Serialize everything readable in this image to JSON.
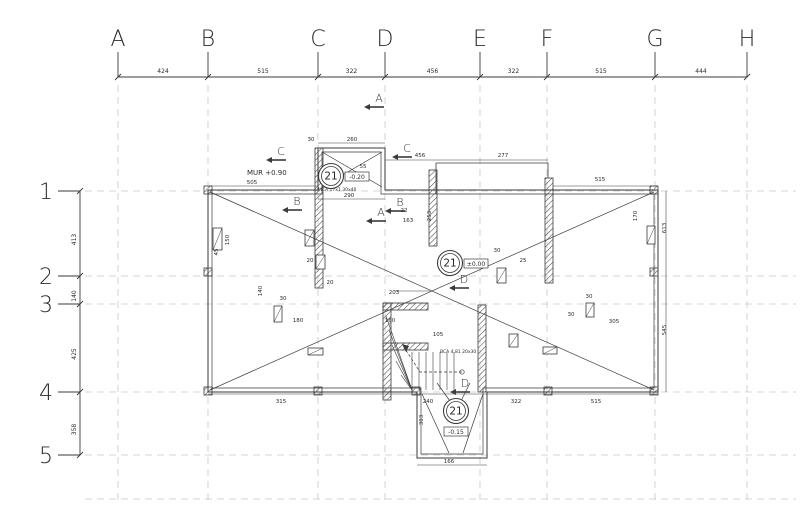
{
  "drawing": {
    "colors": {
      "line": "#3a3a3a",
      "grid": "#c8c8c8",
      "hatch": "#4a4a4a",
      "text": "#2a2a2a"
    },
    "axes": {
      "cols": [
        {
          "label": "A",
          "x": 118
        },
        {
          "label": "B",
          "x": 208
        },
        {
          "label": "C",
          "x": 318
        },
        {
          "label": "D",
          "x": 385
        },
        {
          "label": "E",
          "x": 480
        },
        {
          "label": "F",
          "x": 547
        },
        {
          "label": "G",
          "x": 655
        },
        {
          "label": "H",
          "x": 747
        }
      ],
      "col_dims": [
        "424",
        "515",
        "322",
        "456",
        "322",
        "515",
        "444"
      ],
      "rows": [
        {
          "label": "1",
          "y": 191
        },
        {
          "label": "2",
          "y": 276
        },
        {
          "label": "3",
          "y": 304
        },
        {
          "label": "4",
          "y": 392
        },
        {
          "label": "5",
          "y": 455
        }
      ],
      "row_dims": [
        "413",
        "140",
        "425",
        "358"
      ],
      "top_dim_y": 77,
      "left_dim_x": 80,
      "extra_row_y": 499
    },
    "levels": [
      {
        "num": "21",
        "value": "-0.20",
        "x": 331,
        "y": 176,
        "bx": 14,
        "by": -4
      },
      {
        "num": "21",
        "value": "±0.00",
        "x": 450,
        "y": 263,
        "bx": 14,
        "by": -4
      },
      {
        "num": "21",
        "value": "-0.15",
        "x": 456,
        "y": 411,
        "bx": -12,
        "by": 16
      }
    ],
    "sections": [
      {
        "l": "A",
        "x": 379,
        "y": 102
      },
      {
        "l": "A",
        "x": 381,
        "y": 216
      },
      {
        "l": "B",
        "x": 297,
        "y": 205
      },
      {
        "l": "B",
        "x": 400,
        "y": 206
      },
      {
        "l": "C",
        "x": 281,
        "y": 155
      },
      {
        "l": "C",
        "x": 407,
        "y": 152
      },
      {
        "l": "D",
        "x": 464,
        "y": 283
      },
      {
        "l": "D",
        "x": 465,
        "y": 387
      }
    ],
    "notes": [
      {
        "t": "MUR +0.90",
        "x": 247,
        "y": 175,
        "s": 7
      },
      {
        "t": "MCA 17x1 30x40",
        "x": 318,
        "y": 191,
        "s": 4.5
      },
      {
        "t": "BCA 4.81 20x30",
        "x": 440,
        "y": 353,
        "s": 4.5
      }
    ],
    "dims": [
      {
        "t": "505",
        "x": 252,
        "y": 184
      },
      {
        "t": "260",
        "x": 352,
        "y": 141
      },
      {
        "t": "30",
        "x": 311,
        "y": 141
      },
      {
        "t": "456",
        "x": 420,
        "y": 157
      },
      {
        "t": "277",
        "x": 503,
        "y": 157
      },
      {
        "t": "515",
        "x": 600,
        "y": 181
      },
      {
        "t": "290",
        "x": 349,
        "y": 197
      },
      {
        "t": "163",
        "x": 408,
        "y": 222
      },
      {
        "t": "253",
        "x": 431,
        "y": 216,
        "r": 1
      },
      {
        "t": "613",
        "x": 666,
        "y": 228,
        "r": 1
      },
      {
        "t": "545",
        "x": 666,
        "y": 330,
        "r": 1
      },
      {
        "t": "150",
        "x": 229,
        "y": 240,
        "r": 1
      },
      {
        "t": "140",
        "x": 262,
        "y": 291,
        "r": 1
      },
      {
        "t": "170",
        "x": 637,
        "y": 216,
        "r": 1
      },
      {
        "t": "180",
        "x": 298,
        "y": 322
      },
      {
        "t": "203",
        "x": 394,
        "y": 294
      },
      {
        "t": "160",
        "x": 390,
        "y": 322
      },
      {
        "t": "105",
        "x": 438,
        "y": 336
      },
      {
        "t": "305",
        "x": 614,
        "y": 323
      },
      {
        "t": "315",
        "x": 281,
        "y": 403
      },
      {
        "t": "240",
        "x": 428,
        "y": 403
      },
      {
        "t": "322",
        "x": 516,
        "y": 403
      },
      {
        "t": "515",
        "x": 596,
        "y": 403
      },
      {
        "t": "166",
        "x": 449,
        "y": 463
      },
      {
        "t": "303",
        "x": 423,
        "y": 420,
        "r": 1
      },
      {
        "t": "30",
        "x": 497,
        "y": 252
      },
      {
        "t": "25",
        "x": 523,
        "y": 262
      },
      {
        "t": "30",
        "x": 589,
        "y": 298
      },
      {
        "t": "20",
        "x": 310,
        "y": 262
      },
      {
        "t": "30",
        "x": 283,
        "y": 300
      },
      {
        "t": "30",
        "x": 571,
        "y": 316
      },
      {
        "t": "55",
        "x": 363,
        "y": 168
      },
      {
        "t": "22",
        "x": 404,
        "y": 212
      },
      {
        "t": "20",
        "x": 330,
        "y": 284
      },
      {
        "t": "45",
        "x": 218,
        "y": 252,
        "r": 1
      }
    ],
    "geometry": {
      "outer_path": "M208,190 L318,190 L318,148 L385,148 L385,190 L658,190 L658,392 L487,392 L487,458 L417,458 L417,392 L208,392 Z",
      "inner_path": "M212,194 L322,194 L322,152 L381,152 L381,194 L654,194 L654,388 L483,388 L483,454 L421,454 L421,388 L212,388 Z",
      "extra_walls": [
        [
          436,
          163,
          548,
          163
        ],
        [
          436,
          163,
          436,
          194
        ],
        [
          548,
          163,
          548,
          178
        ]
      ],
      "dim_lines": [
        [
          208,
          186,
          318,
          186
        ],
        [
          318,
          143,
          385,
          143
        ],
        [
          318,
          199,
          385,
          199
        ],
        [
          385,
          160,
          548,
          160
        ],
        [
          553,
          186,
          658,
          186
        ],
        [
          208,
          394,
          658,
          394
        ],
        [
          666,
          191,
          666,
          392
        ],
        [
          417,
          465,
          487,
          465
        ],
        [
          395,
          291,
          430,
          291
        ]
      ],
      "hatch_rects": [
        [
          315,
          148,
          8,
          140
        ],
        [
          429,
          170,
          8,
          76
        ],
        [
          545,
          178,
          8,
          105
        ],
        [
          383,
          303,
          8,
          97
        ],
        [
          478,
          305,
          8,
          87
        ],
        [
          383,
          303,
          45,
          7
        ],
        [
          383,
          343,
          45,
          7
        ]
      ],
      "blocks": [
        [
          204,
          186
        ],
        [
          204,
          268
        ],
        [
          204,
          387
        ],
        [
          314,
          387
        ],
        [
          412,
          387
        ],
        [
          544,
          387
        ],
        [
          650,
          387
        ],
        [
          650,
          268
        ],
        [
          650,
          186
        ]
      ],
      "piers": [
        [
          213,
          228,
          9,
          22
        ],
        [
          274,
          306,
          8,
          16
        ],
        [
          305,
          230,
          9,
          16
        ],
        [
          308,
          348,
          15,
          7
        ],
        [
          497,
          268,
          9,
          15
        ],
        [
          586,
          303,
          8,
          14
        ],
        [
          647,
          226,
          8,
          18
        ],
        [
          543,
          347,
          14,
          7
        ],
        [
          509,
          334,
          9,
          13
        ],
        [
          316,
          255,
          9,
          14
        ]
      ],
      "diagonals": [
        [
          210,
          192,
          654,
          390
        ],
        [
          210,
          390,
          654,
          192
        ],
        [
          322,
          152,
          382,
          187
        ],
        [
          382,
          152,
          322,
          187
        ],
        [
          422,
          394,
          449,
          453
        ],
        [
          483,
          394,
          463,
          453
        ],
        [
          437,
          383,
          450,
          401
        ],
        [
          470,
          383,
          461,
          401
        ]
      ],
      "stair": {
        "risers": [
          [
            412,
            352,
            412,
            390
          ],
          [
            419,
            352,
            419,
            390
          ],
          [
            426,
            352,
            426,
            390
          ],
          [
            433,
            352,
            433,
            390
          ],
          [
            440,
            352,
            440,
            390
          ],
          [
            447,
            352,
            447,
            390
          ],
          [
            454,
            352,
            454,
            390
          ]
        ],
        "fan": [
          [
            412,
            390,
            386,
            316
          ],
          [
            412,
            390,
            389,
            330
          ],
          [
            412,
            390,
            392,
            345
          ],
          [
            412,
            390,
            396,
            361
          ],
          [
            412,
            390,
            401,
            375
          ]
        ],
        "walk": [
          [
            462,
            372
          ],
          [
            420,
            372
          ],
          [
            402,
            344
          ]
        ],
        "arrow": [
          [
            402,
            344
          ],
          [
            409,
            346
          ],
          [
            406,
            352
          ]
        ],
        "walk_start": [
          462,
          372
        ]
      }
    }
  }
}
